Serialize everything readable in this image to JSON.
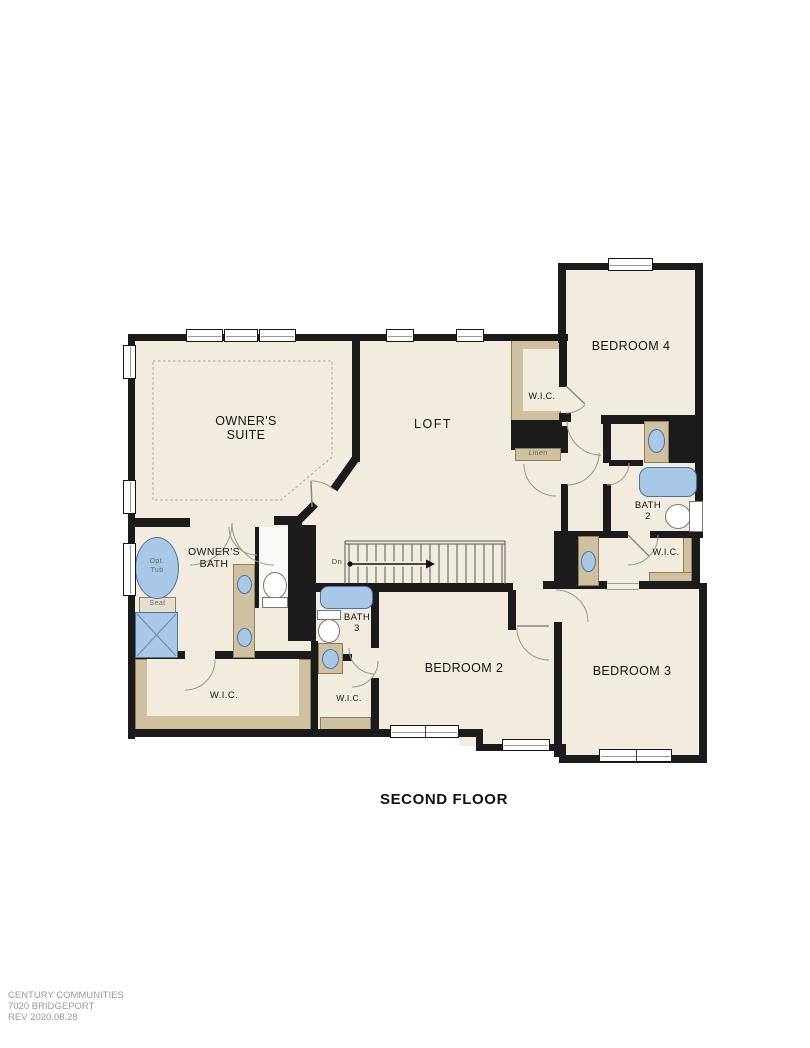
{
  "title": "SECOND FLOOR",
  "footer": {
    "line1": "CENTURY COMMUNITIES",
    "line2": "7020 BRIDGEPORT",
    "line3": "REV 2020.08.28"
  },
  "rooms": {
    "owners_suite": {
      "label_line1": "OWNER'S",
      "label_line2": "SUITE"
    },
    "loft": {
      "label": "LOFT"
    },
    "bedroom_4": {
      "label": "BEDROOM 4"
    },
    "bedroom_2": {
      "label": "BEDROOM 2"
    },
    "bedroom_3": {
      "label": "BEDROOM 3"
    },
    "owners_bath": {
      "label_line1": "OWNER'S",
      "label_line2": "BATH"
    },
    "bath_2": {
      "label_line1": "BATH",
      "label_line2": "2"
    },
    "bath_3": {
      "label_line1": "BATH",
      "label_line2": "3"
    },
    "wic_owners": {
      "label": "W.I.C."
    },
    "wic_bedroom_4": {
      "label": "W.I.C."
    },
    "wic_bedroom_3": {
      "label": "W.I.C."
    },
    "wic_bedroom_2": {
      "label": "W.I.C."
    },
    "linen": {
      "label": "Linen"
    }
  },
  "fixtures": {
    "opt_tub_line1": "Opt.",
    "opt_tub_line2": "Tub",
    "seat": "Seat",
    "stairs_direction": "Dn"
  },
  "colors": {
    "wall": "#1b1b1b",
    "floor": "#f2ecdf",
    "closet_shelf": "#cfc19f",
    "fixture_blue": "#a9c8e8",
    "fixture_outline": "#4f739c",
    "footer_text": "#9a9a9a"
  }
}
